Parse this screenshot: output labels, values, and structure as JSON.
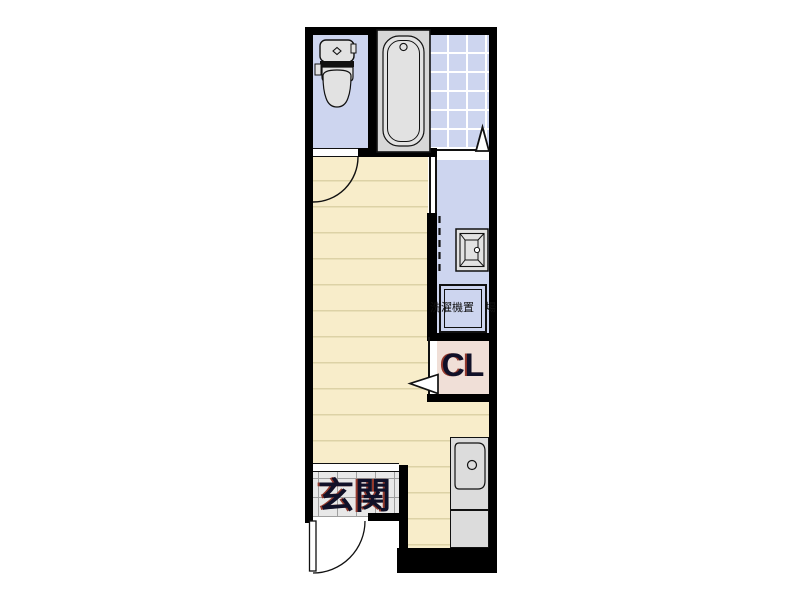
{
  "plan": {
    "type": "apartment-floor-plan",
    "labels": {
      "entrance": "玄関",
      "closet": "CL",
      "washer_line1": "洗濯機",
      "washer_line2": "置　場"
    },
    "rooms": [
      {
        "name": "toilet-room"
      },
      {
        "name": "bathroom"
      },
      {
        "name": "washroom-corridor"
      },
      {
        "name": "washing-machine-space",
        "label": "洗濯機置場"
      },
      {
        "name": "closet",
        "label": "CL"
      },
      {
        "name": "main-room"
      },
      {
        "name": "entrance",
        "label": "玄関"
      },
      {
        "name": "kitchen"
      }
    ],
    "colors": {
      "wall": "#000000",
      "lavender_floor": "#cdd5ef",
      "wood_floor": "#f8edca",
      "wood_line": "#ddd2a6",
      "closet_floor": "#f0dfd7",
      "genkan_tile": "#e8e8e8",
      "genkan_grid": "#9f9f9f",
      "fixture_gray": "#e2e2e2",
      "tub_surround": "#d7d7d7",
      "counter_gray": "#dcdcdc",
      "label_ink": "#101028",
      "label_shadow": "#95392c"
    }
  }
}
